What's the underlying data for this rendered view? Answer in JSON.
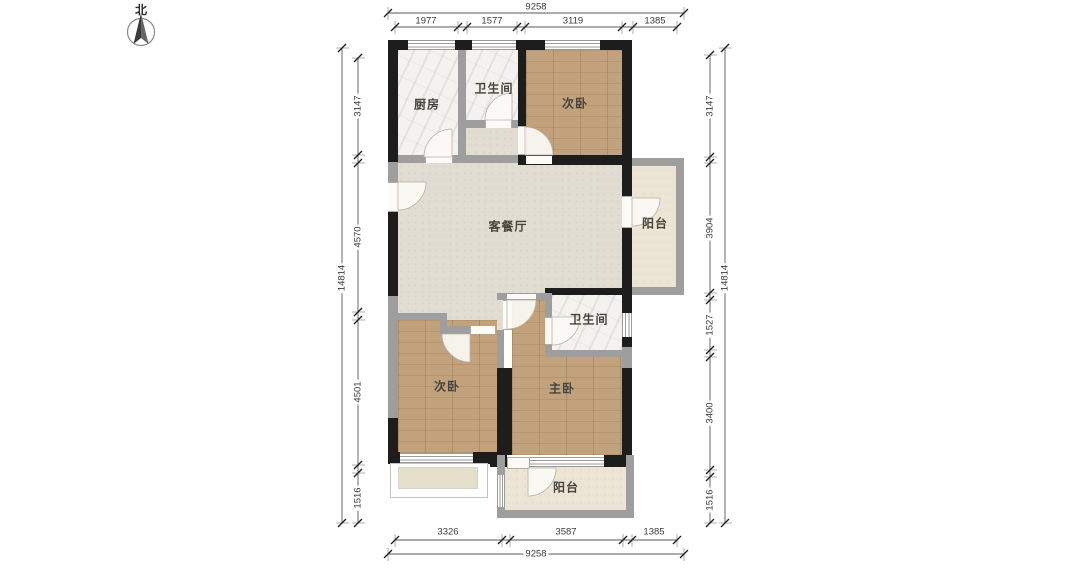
{
  "compass": {
    "label": "北"
  },
  "rooms": {
    "kitchen": "厨房",
    "bath_top": "卫生间",
    "bedroom_top": "次卧",
    "living": "客餐厅",
    "balcony_right": "阳台",
    "bath_lower": "卫生间",
    "bedroom_lower": "次卧",
    "master": "主卧",
    "balcony_bottom": "阳台"
  },
  "dimensions": {
    "top": {
      "total": "9258",
      "segments": [
        "1977",
        "1577",
        "3119",
        "1385"
      ]
    },
    "bottom": {
      "total": "9258",
      "segments": [
        "3326",
        "3587",
        "1385"
      ]
    },
    "left": {
      "total": "14814",
      "segments": [
        "3147",
        "4570",
        "4501",
        "1516"
      ]
    },
    "right": {
      "total": "14814",
      "segments": [
        "3147",
        "3904",
        "1527",
        "3400",
        "1516"
      ]
    }
  },
  "colors": {
    "wall_exterior": "#1d1d1d",
    "wall_interior": "#9e9e9e",
    "floor_wood": "#c2a27c",
    "floor_tile": "#e1ddd2",
    "floor_marble": "#f3f2ef",
    "floor_balcony": "#ece4d4"
  }
}
